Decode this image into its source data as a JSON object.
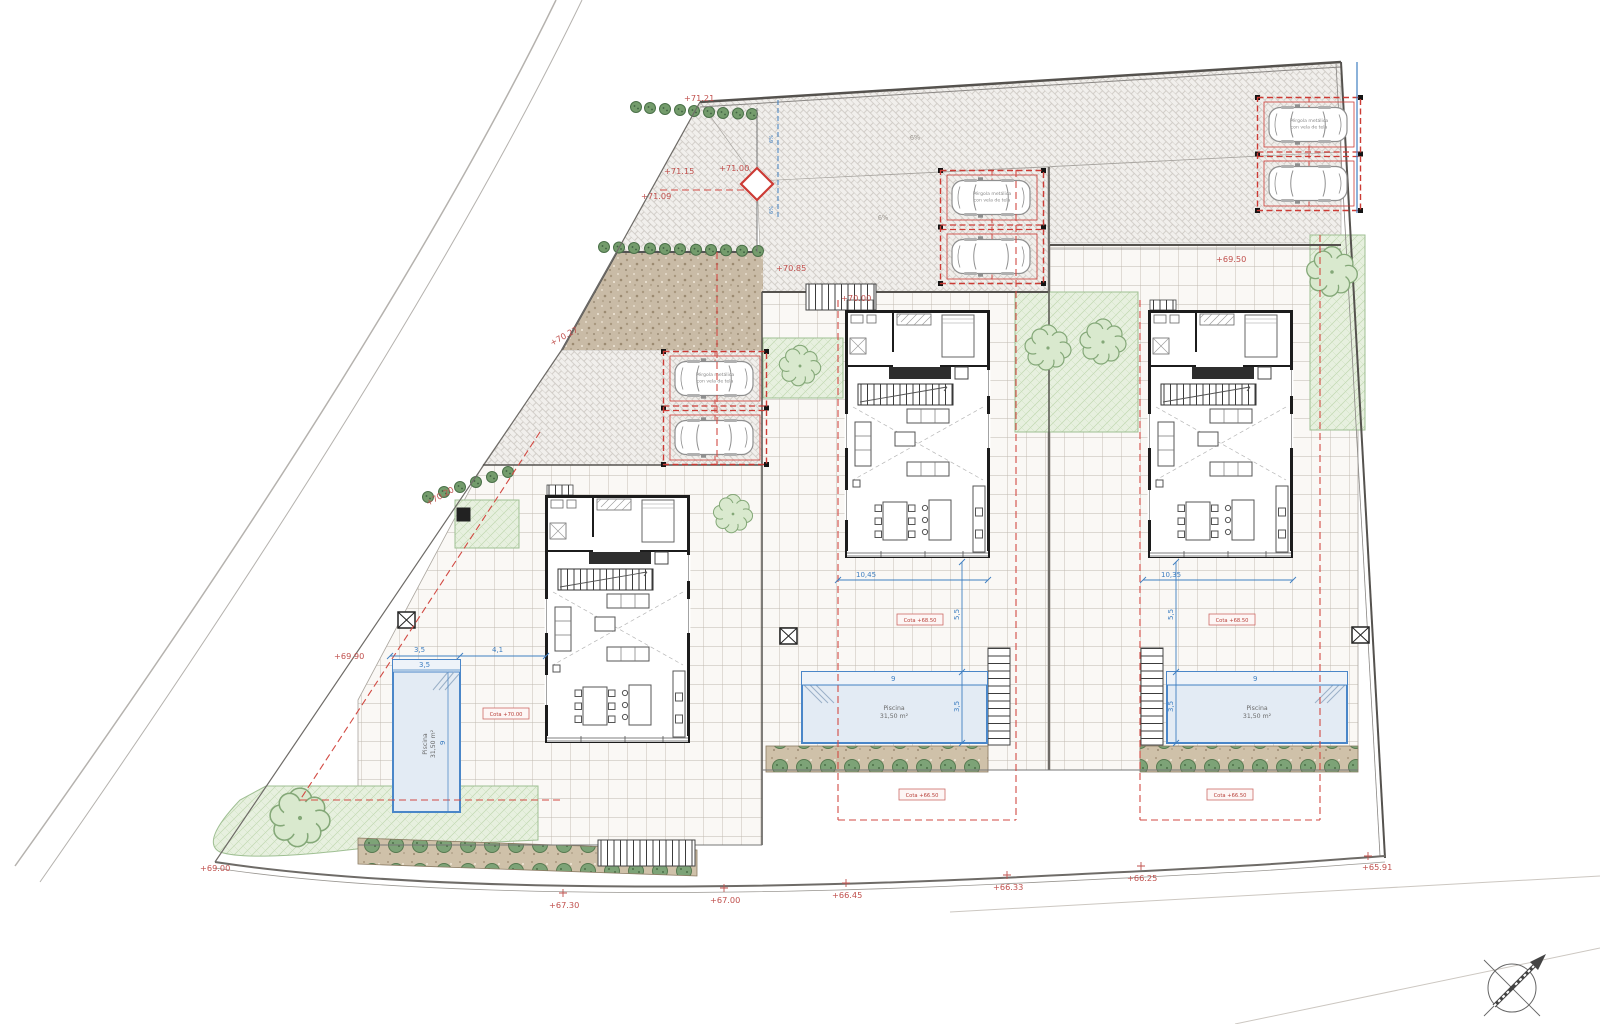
{
  "drawing": {
    "pergola_label": {
      "line1": "Pérgola metálica",
      "line2": "con vela de tela"
    },
    "pool_label": {
      "line1": "Piscina",
      "line2": "31,50 m²"
    },
    "slope_label": "6%",
    "elevation_labels": {
      "top1": "+71.21",
      "top2": "+71.15",
      "top3": "+71.09",
      "top4": "+71.00",
      "drive1": "+70.85",
      "drive2": "+70.00",
      "west1": "+70.27",
      "west2": "+70.20",
      "west3": "+69.90",
      "east1": "+69.50",
      "south1": "+69.00",
      "south2": "+67.30",
      "south3": "+67.00",
      "south4": "+66.45",
      "south5": "+66.33",
      "south6": "+66.25",
      "south7": "+65.91"
    },
    "level_tags": {
      "t7000": "Cota +70.00",
      "t6850": "Cota +68.50",
      "t6650": "Cota +66.50"
    },
    "dimensions": {
      "d1045": "10,45",
      "d1035": "10,35",
      "d55": "5,5",
      "d35": "3,5",
      "d9": "9",
      "d41": "4,1"
    },
    "colors": {
      "annotation_red": "#c0504d",
      "setback_red": "#d24a43",
      "dimension_blue": "#3f7fc1",
      "pool_blue": "#4a86c8",
      "pool_fill": "#e3ebf4",
      "vegetation_green": "#7da377",
      "grass_fill": "#e7f0df",
      "gravel_brown": "#c9bba6",
      "paving_gray": "#c9c5bf"
    }
  }
}
